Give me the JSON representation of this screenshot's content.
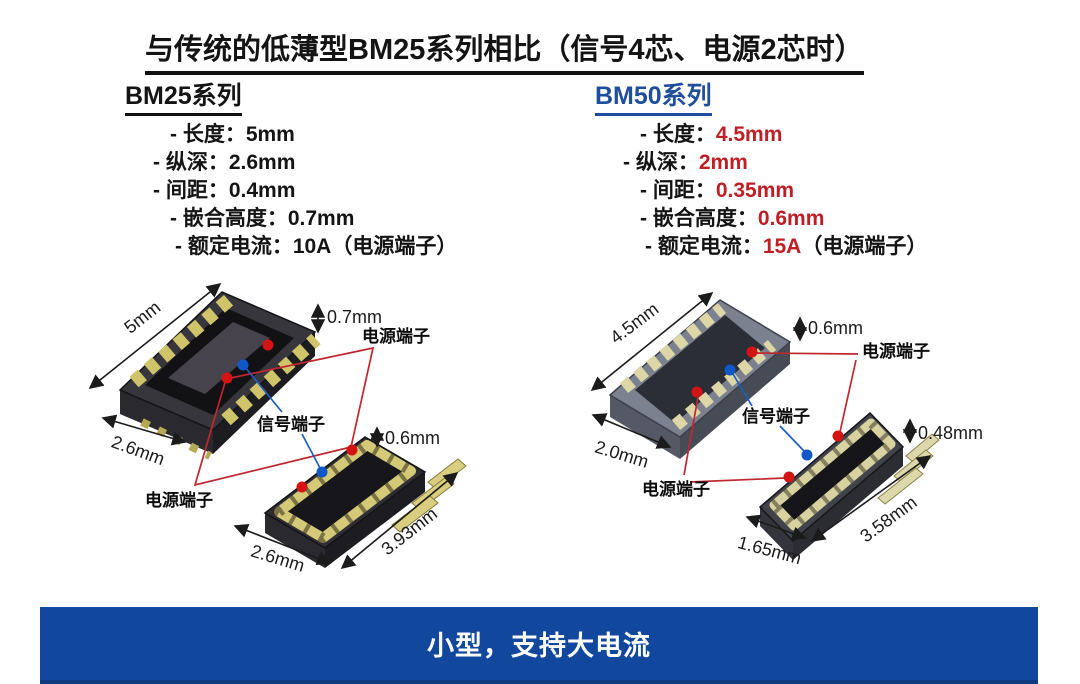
{
  "title": "与传统的低薄型BM25系列相比（信号4芯、电源2芯时）",
  "colors": {
    "accent_blue": "#1F4E9C",
    "value_red": "#BE1E24",
    "banner_blue": "#11489D",
    "line_red": "#C0272F",
    "line_blue": "#1C5FC2"
  },
  "bm25": {
    "heading": "BM25系列",
    "specs": [
      {
        "label": "- 长度：",
        "value": "5mm",
        "suffix": ""
      },
      {
        "label": "- 纵深：",
        "value": "2.6mm",
        "suffix": ""
      },
      {
        "label": "- 间距：",
        "value": "0.4mm",
        "suffix": ""
      },
      {
        "label": "- 嵌合高度：",
        "value": "0.7mm",
        "suffix": ""
      },
      {
        "label": "- 额定电流：",
        "value": "10A",
        "suffix": "（电源端子）"
      }
    ],
    "diagram": {
      "length": "5mm",
      "depth": "2.6mm",
      "height": "0.7mm",
      "plug_height": "0.6mm",
      "plug_depth": "2.6mm",
      "plug_length": "3.93mm",
      "power_label_top": "电源端子",
      "signal_label": "信号端子",
      "power_label_bottom": "电源端子"
    }
  },
  "bm50": {
    "heading": "BM50系列",
    "specs": [
      {
        "label": "- 长度：",
        "value": "4.5mm",
        "suffix": ""
      },
      {
        "label": "- 纵深：",
        "value": "2mm",
        "suffix": ""
      },
      {
        "label": "- 间距：",
        "value": "0.35mm",
        "suffix": ""
      },
      {
        "label": "- 嵌合高度：",
        "value": "0.6mm",
        "suffix": ""
      },
      {
        "label": "- 额定电流：",
        "value": "15A",
        "suffix": "（电源端子）"
      }
    ],
    "diagram": {
      "length": "4.5mm",
      "depth": "2.0mm",
      "height": "0.6mm",
      "plug_height": "0.48mm",
      "plug_depth": "1.65mm",
      "plug_length": "3.58mm",
      "power_label_top": "电源端子",
      "signal_label": "信号端子",
      "power_label_bottom": "电源端子"
    }
  },
  "banner": {
    "text": "小型，支持大电流"
  }
}
